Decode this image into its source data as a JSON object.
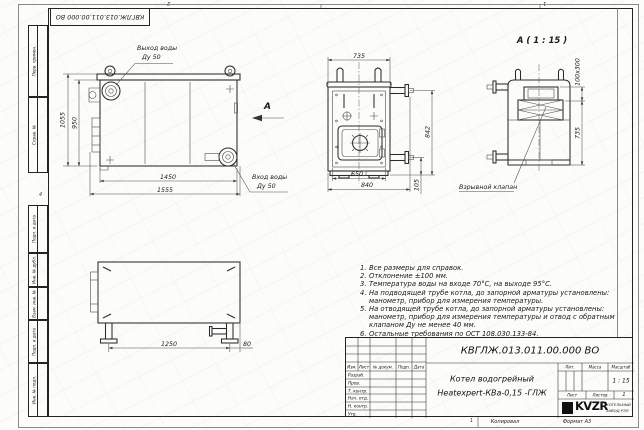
{
  "sheet": {
    "stamp_top": "КВГЛЖ.013.011.00.000 ВО",
    "zone_top_left": "2",
    "zone_top_right": "1",
    "zone_left": "4",
    "zone_bottom": "1",
    "side_labels": [
      "Перв. примен.",
      "Справ. №",
      "Подп. и дата",
      "Инв. № дубл.",
      "Взам. инв. №",
      "Подп. и дата",
      "Инв. № подл."
    ]
  },
  "views": {
    "side": {
      "outlet_label_1": "Выход воды",
      "outlet_label_2": "Ду 50",
      "inlet_label_1": "Вход воды",
      "inlet_label_2": "Ду 50",
      "view_arrow": "А",
      "dim_height_total": "1055",
      "dim_height_body": "950",
      "dim_width_inner": "1450",
      "dim_width_total": "1555"
    },
    "front": {
      "dim_top": "735",
      "dim_right": "842",
      "dim_bottom_inner": "650",
      "dim_bottom_outer": "840",
      "dim_pipe": "105"
    },
    "detail": {
      "title": "А ( 1 : 15 )",
      "dim_flue": "100х300",
      "dim_height": "735",
      "valve_label": "Взрывной клапан"
    },
    "bottom": {
      "dim_legs": "1250",
      "dim_offset": "80"
    }
  },
  "notes": [
    {
      "num": "1.",
      "text": "Все размеры для справок."
    },
    {
      "num": "2.",
      "text": "Отклонение ±100 мм."
    },
    {
      "num": "3.",
      "text": "Температура воды на входе 70°С, на выходе 95°С."
    },
    {
      "num": "4.",
      "text": "На подводящей трубе котла, до запорной арматуры установлены:"
    },
    {
      "num": "",
      "text": "манометр, прибор для измерения температуры."
    },
    {
      "num": "5.",
      "text": "На отводящей трубе котла, до запорной арматуры установлены:"
    },
    {
      "num": "",
      "text": "манометр, прибор для измерения температуры и отвод с обратным"
    },
    {
      "num": "",
      "text": "клапаном Ду не менее 40 мм."
    },
    {
      "num": "6.",
      "text": "Остальные требования по ОСТ 108.030.133-84."
    }
  ],
  "title_block": {
    "designation": "КВГЛЖ.013.011.00.000 ВО",
    "product_name_1": "Котел водогрейный",
    "product_name_2": "Heatexpert-КВа-0,15 -ГЛЖ",
    "col_izm": "Изм.",
    "col_list": "Лист",
    "col_doc": "№ докум.",
    "col_podp": "Подп.",
    "col_data": "Дата",
    "row_labels": [
      "Разраб.",
      "Пров.",
      "Т. контр.",
      "Нач. отд.",
      "Н. контр.",
      "Утв."
    ],
    "lit_label": "Лит.",
    "mass_label": "Масса",
    "scale_label": "Масштаб",
    "scale_value": "1 : 15",
    "sheet_label": "Лист",
    "sheets_label": "Листов",
    "sheets_value": "1",
    "logo_text": "KVZR",
    "org_line_1": "КОТЕЛЬНЫЙ",
    "org_line_2": "ЗАВОД РЭП",
    "copied_label": "Копировал",
    "format_label": "Формат А3"
  },
  "colors": {
    "line": "#2b2b2b",
    "paper": "#fcfcfa"
  }
}
